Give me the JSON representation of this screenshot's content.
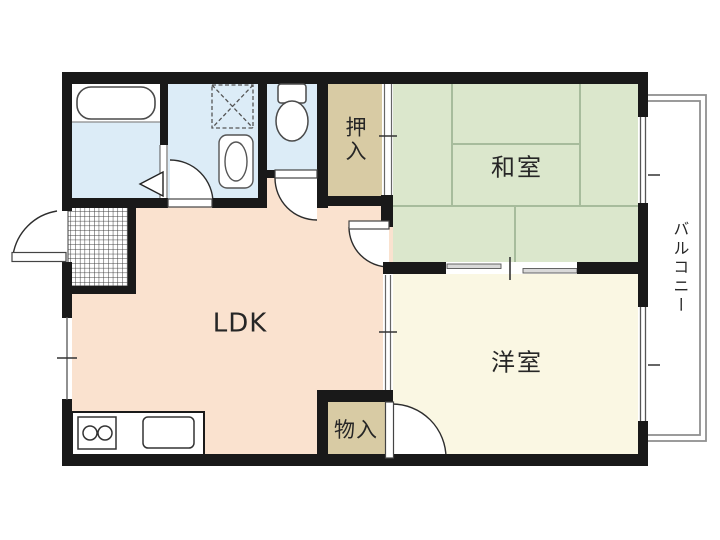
{
  "floor_plan": {
    "rooms": {
      "ldk": {
        "label": "LDK"
      },
      "washitsu": {
        "label": "和室"
      },
      "youshitsu": {
        "label": "洋室"
      },
      "oshiire": {
        "label": "押入"
      },
      "monoire": {
        "label": "物入"
      },
      "balcony": {
        "label": "バルコニー"
      }
    },
    "colors": {
      "wall": "#191919",
      "ldk_floor": "#fae2cf",
      "tatami_floor": "#dbe7cc",
      "tatami_line": "#a7bc9c",
      "western_floor": "#faf7e3",
      "closet_floor": "#d8cba4",
      "wet_area_floor": "#dcecf7",
      "balcony_line": "#909090"
    },
    "fixtures": {
      "bathtub": "bathtub-icon",
      "washing_machine_pan": "washing-machine-pan-icon",
      "washbasin": "washbasin-icon",
      "toilet": "toilet-icon",
      "stove": "stove-icon",
      "kitchen_sink": "kitchen-sink-icon",
      "entrance_tile": "entrance-tile-pattern"
    }
  }
}
